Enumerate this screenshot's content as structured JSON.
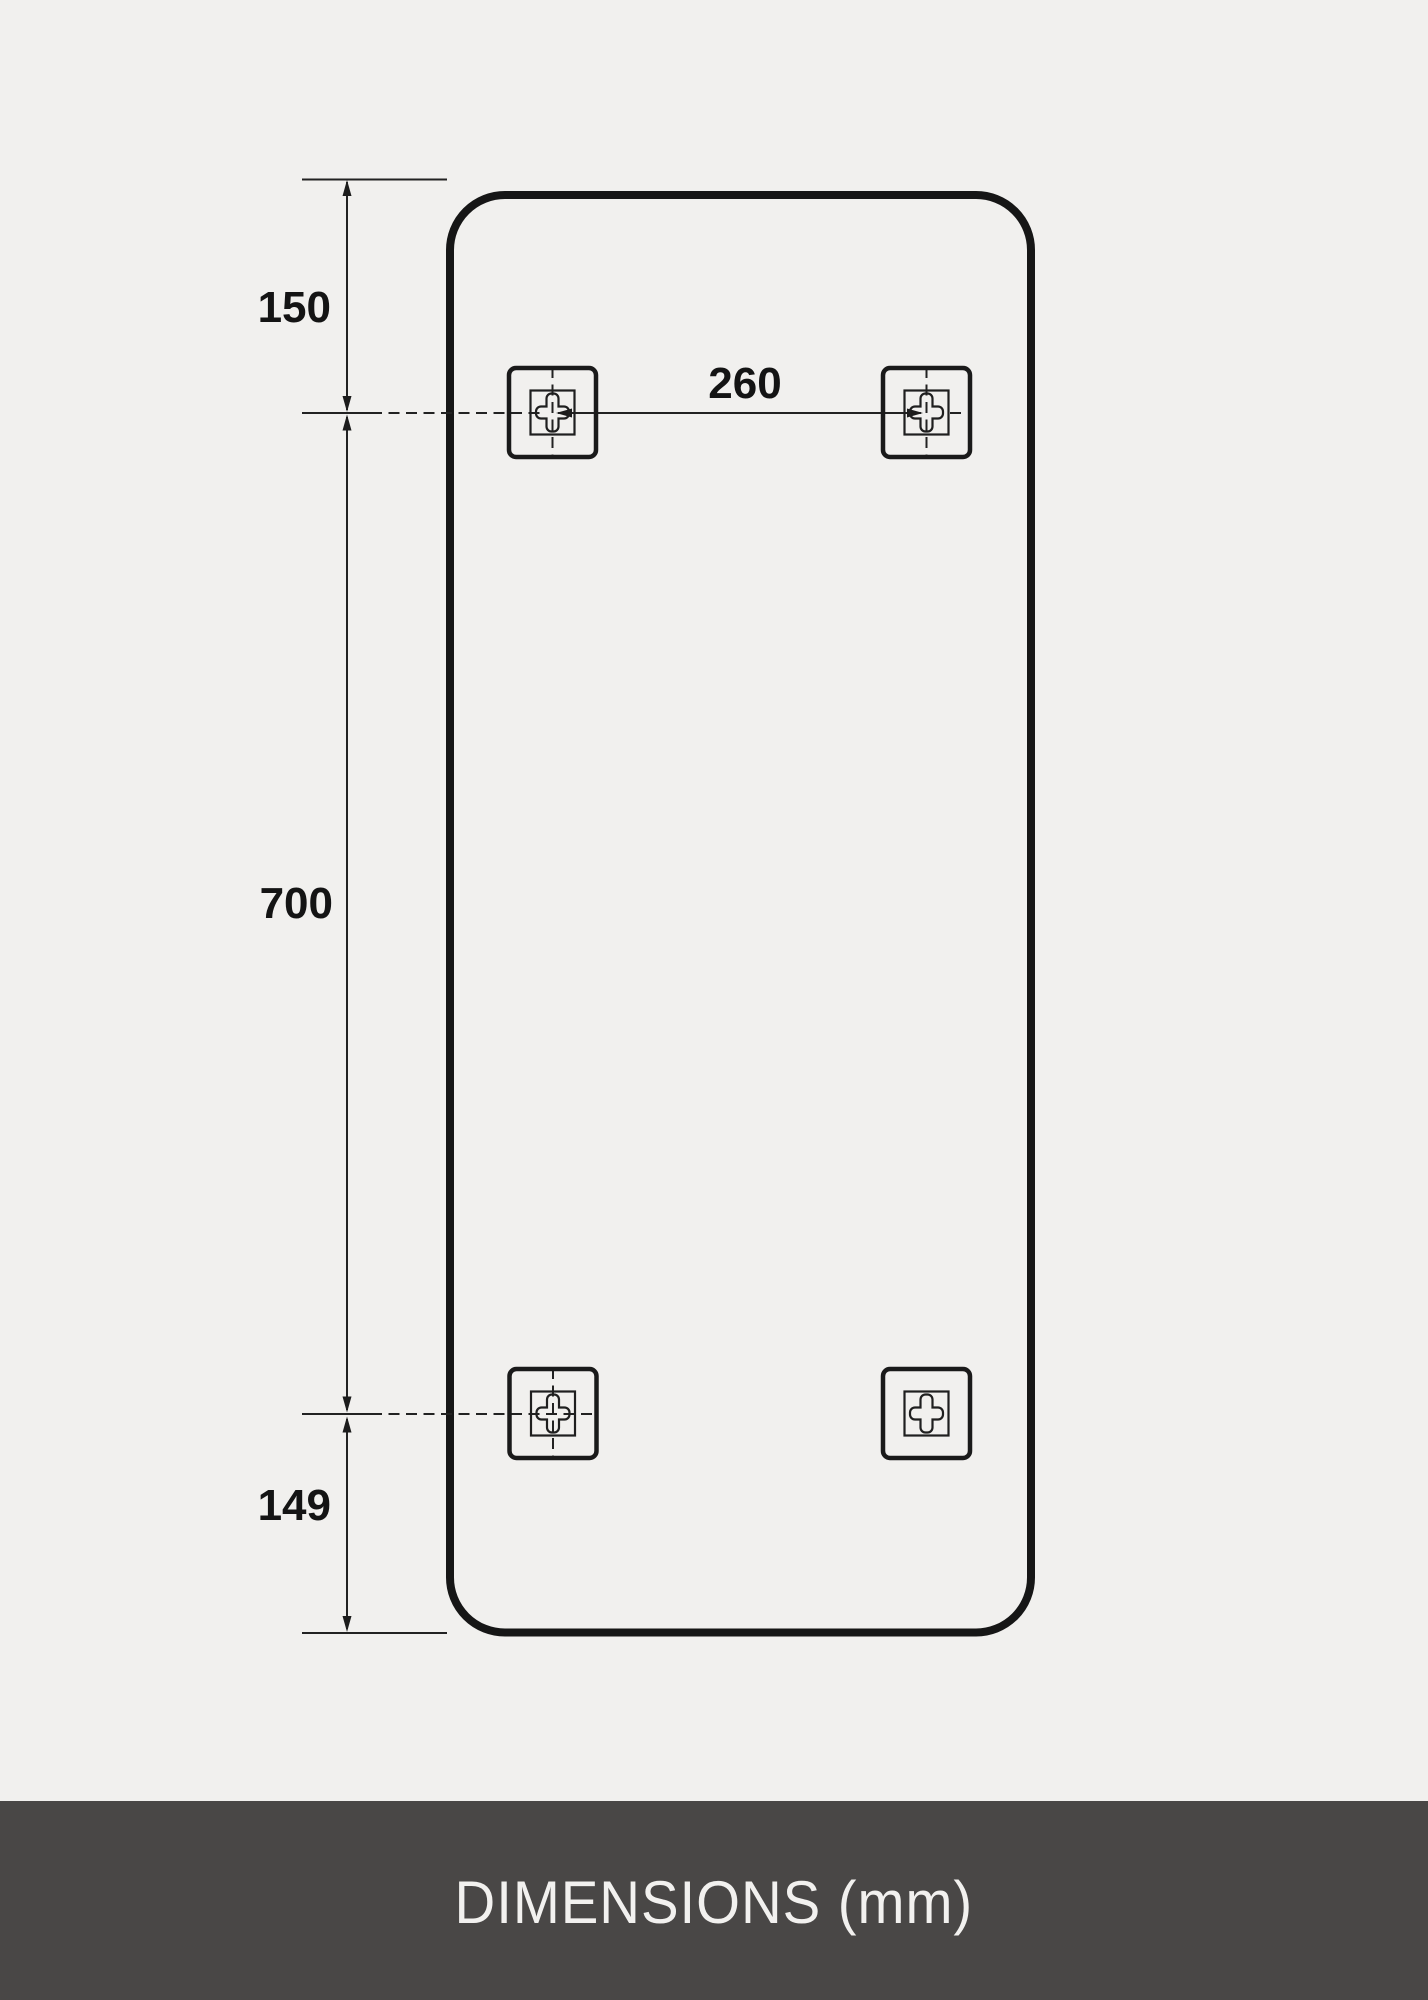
{
  "page": {
    "background_color": "#f1f0ee"
  },
  "drawing": {
    "type": "technical-dimension-diagram",
    "unit": "mm",
    "line_color": "#1a1a1a",
    "dimensions": {
      "top_offset": "150",
      "hole_spacing_horizontal": "260",
      "hole_spacing_vertical": "700",
      "bottom_offset": "149"
    }
  },
  "footer": {
    "label": "DIMENSIONS (mm)",
    "background_color": "#494746",
    "text_color": "#f2f1ef"
  }
}
